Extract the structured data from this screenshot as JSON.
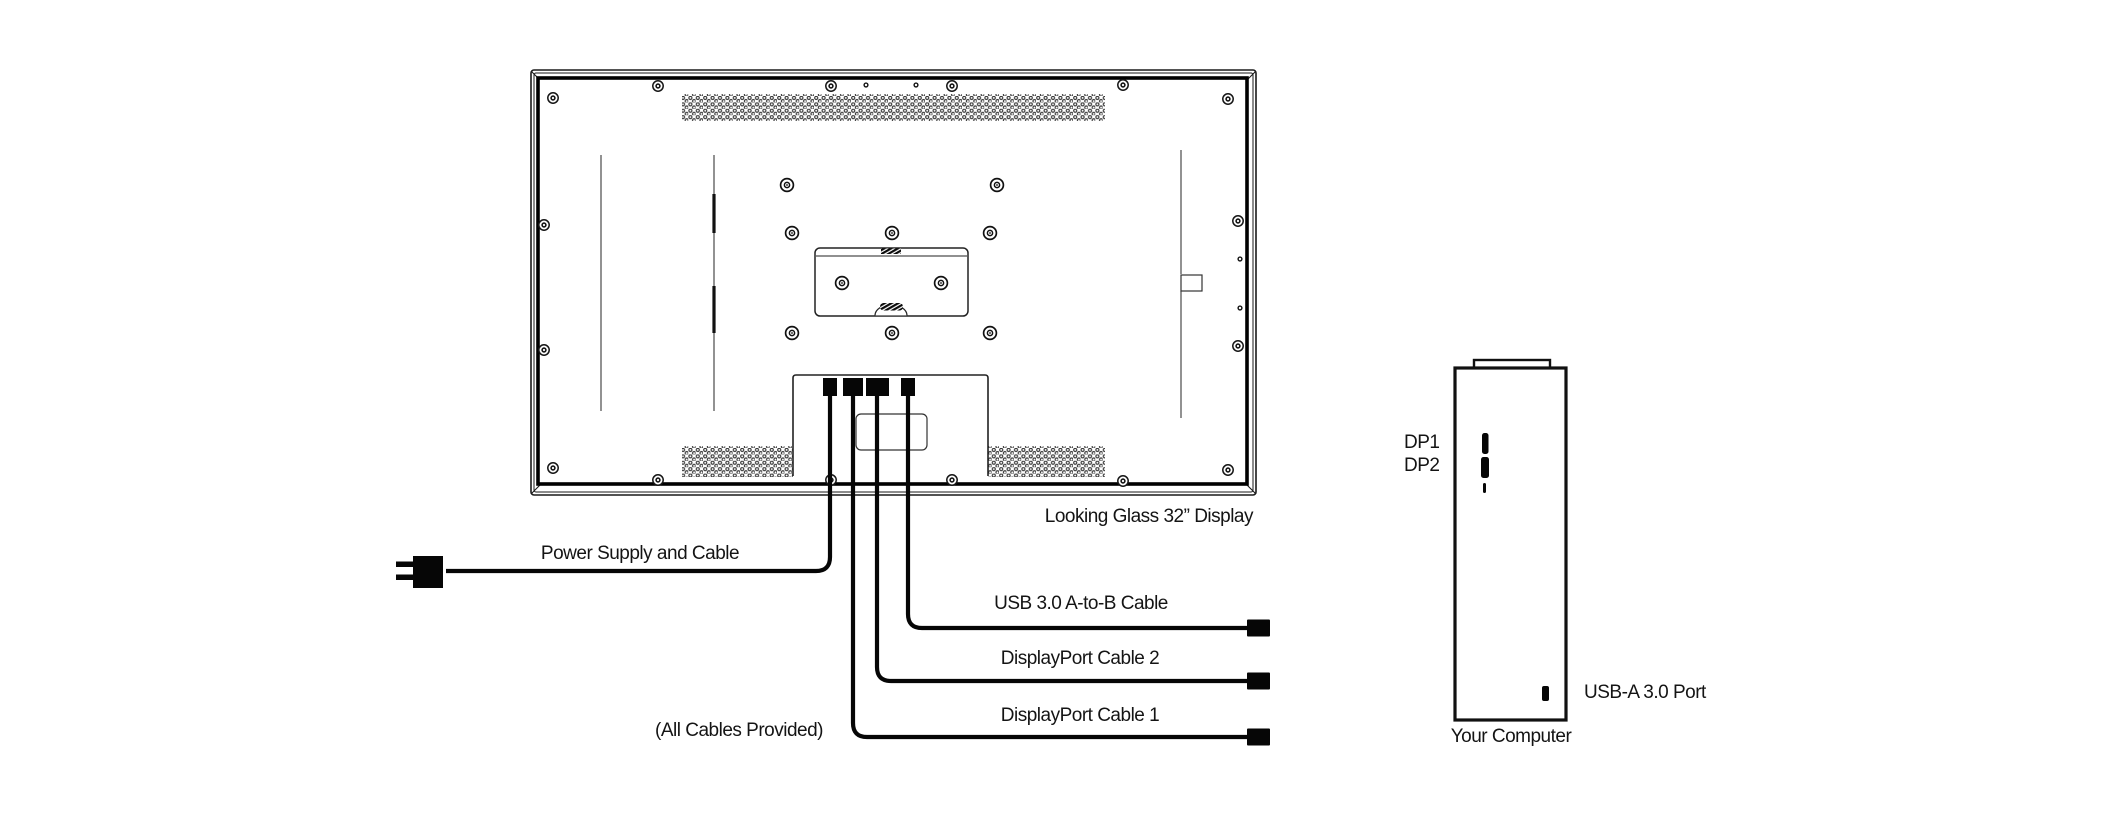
{
  "display": {
    "name": "Looking Glass 32” Display"
  },
  "cables": {
    "power": "Power Supply and Cable",
    "usb": "USB 3.0 A-to-B Cable",
    "dp2": "DisplayPort Cable 2",
    "dp1": "DisplayPort Cable 1",
    "note": "(All Cables Provided)"
  },
  "computer": {
    "name": "Your Computer",
    "dp1_port": "DP1",
    "dp2_port": "DP2",
    "usb_port": "USB-A 3.0 Port"
  },
  "colors": {
    "line": "#111111",
    "background": "#ffffff"
  }
}
